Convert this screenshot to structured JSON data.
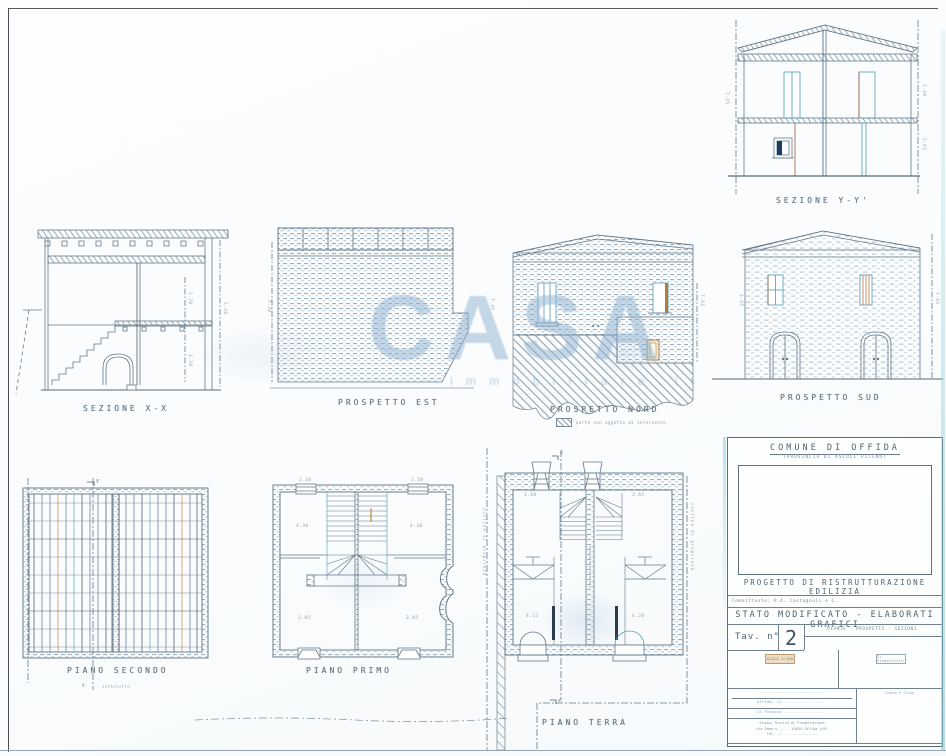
{
  "watermark": {
    "main": "CASA",
    "sub": "i m m o b i l i a r e . i t"
  },
  "drawings": {
    "sezione_yy": {
      "label": "SEZIONE Y-Y'",
      "dims": [
        "7.45",
        "2.40",
        "2.61"
      ]
    },
    "sezione_xx": {
      "label": "SEZIONE X-X",
      "dims": [
        "5.20",
        "2.70",
        "1.50"
      ]
    },
    "prospetto_est": {
      "label": "PROSPETTO EST",
      "dims": [
        "5.20"
      ]
    },
    "prospetto_nord": {
      "label": "PROSPETTO NORD",
      "legend_text": "parte non oggetto di intervento",
      "dims": [
        "7.45",
        "7.65"
      ]
    },
    "prospetto_sud": {
      "label": "PROSPETTO SUD",
      "dims": [
        "2.45",
        "7.65"
      ]
    },
    "piano_secondo": {
      "label": "PIANO SECONDO",
      "sub_label": "sottotetto",
      "marker": "y"
    },
    "piano_primo": {
      "label": "PIANO PRIMO",
      "dims": [
        "2.30",
        "2.50",
        "4.30",
        "4.30",
        "3.85",
        "3.85"
      ]
    },
    "piano_terra": {
      "label": "PIANO TERRA",
      "marker": "x",
      "side_text": "confine di proprietà",
      "dims": [
        "3.60",
        "3.65",
        "4.15",
        "4.20"
      ]
    }
  },
  "title_block": {
    "municipality": "COMUNE DI OFFIDA",
    "province": "(PROVINCIA DI ASCOLI PICENO)",
    "project": "PROGETTO DI RISTRUTTURAZIONE EDILIZIA",
    "client_row": "Committente: P.A. Castagnoli e C.",
    "status": "STATO MODIFICATO - ELABORATI GRAFICI",
    "tav_label": "Tav. n°",
    "tav_number": "2",
    "contents": "PIANTE - PROSPETTI - SEZIONI",
    "scale_box": "SCALA 1:100",
    "designer_box": "Il Progettista",
    "sign_header": "Timbro e firma",
    "info_rows": [
      "...........................",
      "Offida, lì .................",
      "Il Tecnico ................."
    ],
    "studio_lines": [
      "Studio Tecnico di Progettazione",
      "Via Roma n. .. - 63035 Offida (AP)",
      "Tel. ..................."
    ]
  }
}
